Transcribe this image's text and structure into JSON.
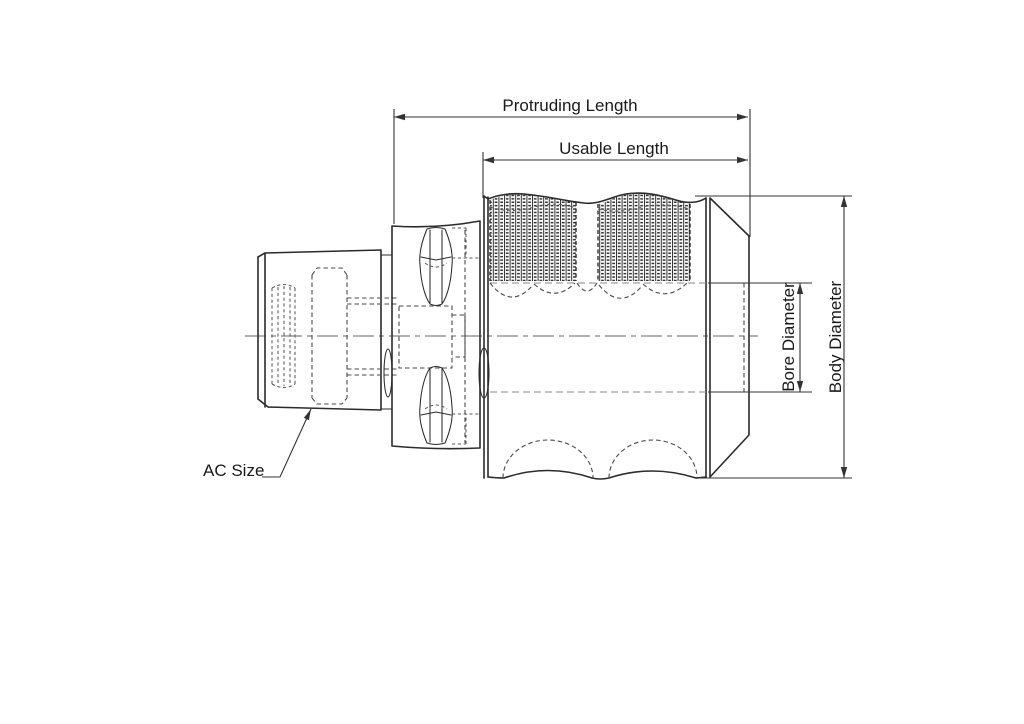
{
  "labels": {
    "protruding_length": "Protruding Length",
    "usable_length": "Usable Length",
    "bore_diameter": "Bore Diameter",
    "body_diameter": "Body Diameter",
    "ac_size": "AC Size"
  },
  "colors": {
    "background": "#ffffff",
    "outline": "#2b2b2b",
    "hidden_line": "#4a4a4a",
    "phantom_line": "#8a8a8a",
    "dimension_line": "#333333",
    "text": "#1a1a1a"
  }
}
